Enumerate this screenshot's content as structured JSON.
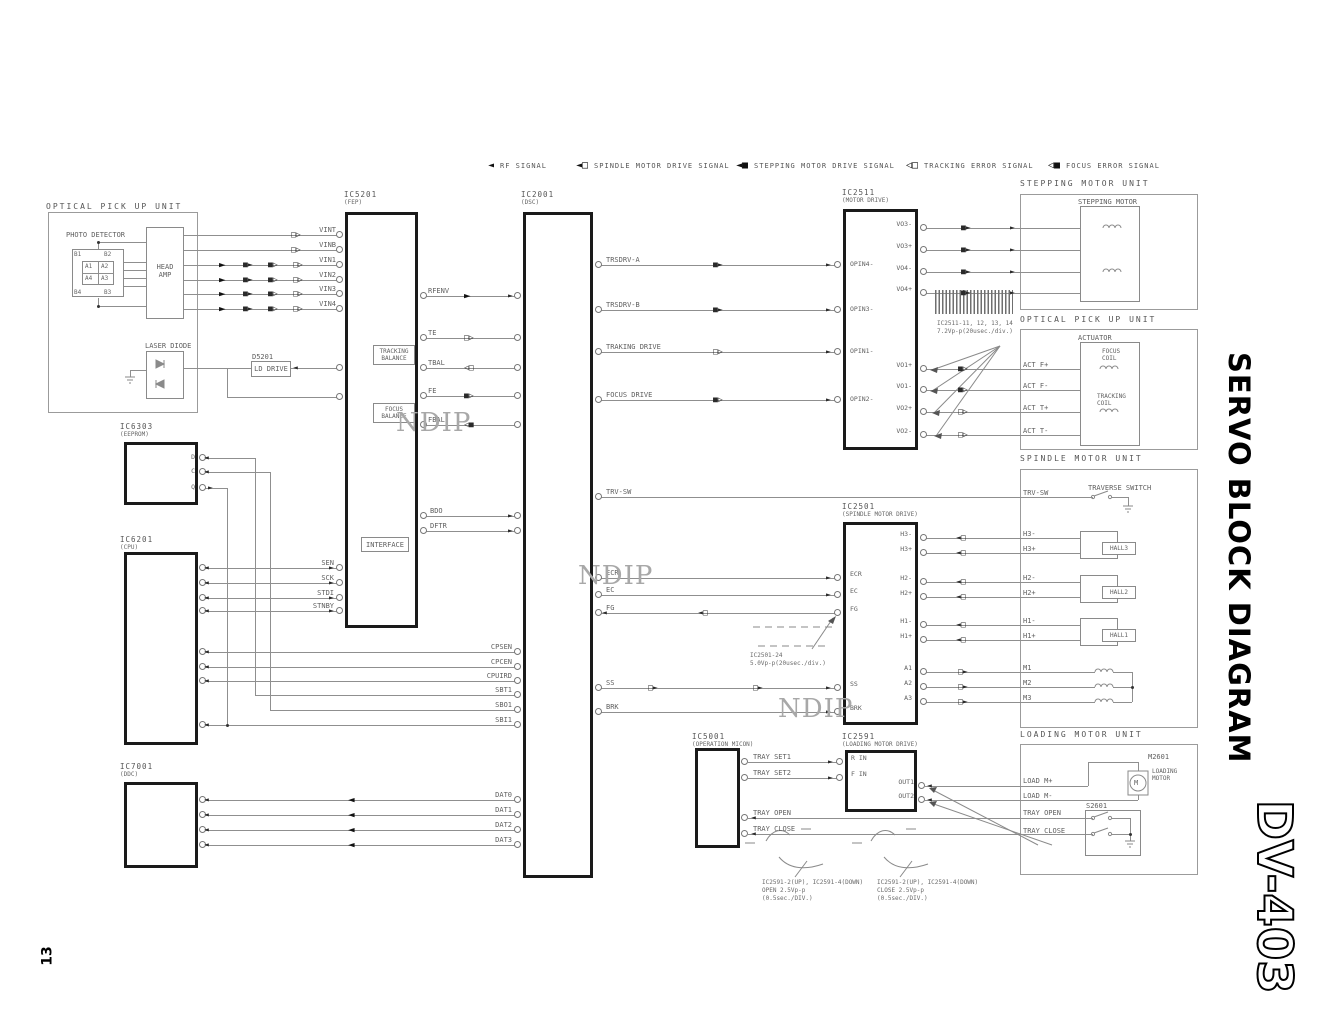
{
  "page": {
    "number": "13",
    "side_title": "SERVO BLOCK DIAGRAM",
    "model": "DV-403",
    "watermark": "NDIP"
  },
  "legend": {
    "rf": "RF SIGNAL",
    "spindle": "SPINDLE MOTOR DRIVE SIGNAL",
    "stepping": "STEPPING MOTOR DRIVE SIGNAL",
    "tracking": "TRACKING ERROR SIGNAL",
    "focus": "FOCUS ERROR SIGNAL"
  },
  "opu_left": {
    "title": "OPTICAL PICK UP UNIT",
    "photo_detector": "PHOTO DETECTOR",
    "cells": [
      "B1",
      "B2",
      "A1",
      "A2",
      "A4",
      "A3",
      "B4",
      "B3"
    ],
    "head_amp": "HEAD\nAMP",
    "laser_diode": "LASER DIODE",
    "d5201": "D5201",
    "ld_drive": "LD DRIVE"
  },
  "ic5201": {
    "name": "IC5201",
    "sub": "(FEP)",
    "inputs": [
      "VINT",
      "VINB",
      "VIN1",
      "VIN2",
      "VIN3",
      "VIN4"
    ],
    "to_dsc": [
      "RFENV",
      "TE",
      "TBAL",
      "FE",
      "FBAL",
      "BDO",
      "DFTR"
    ],
    "serial": [
      "SEN",
      "SCK",
      "STDI",
      "STNBY"
    ],
    "tracking_balance": "TRACKING\nBALANCE",
    "focus_balance": "FOCUS\nBALANCE",
    "interface": "INTERFACE"
  },
  "ic2001": {
    "name": "IC2001",
    "sub": "(DSC)",
    "left": [
      "CPSEN",
      "CPCEN",
      "CPUIRD",
      "SBT1",
      "SBO1",
      "SBI1",
      "DAT0",
      "DAT1",
      "DAT2",
      "DAT3"
    ],
    "right": [
      "TRSDRV-A",
      "TRSDRV-B",
      "TRAKING DRIVE",
      "FOCUS DRIVE",
      "TRV-SW",
      "ECR",
      "EC",
      "FG",
      "SS",
      "BRK"
    ]
  },
  "ic2511": {
    "name": "IC2511",
    "sub": "(MOTOR DRIVE)",
    "left_pins": [
      "OPIN4-",
      "OPIN3-",
      "OPIN1-",
      "OPIN2-"
    ],
    "right_top": [
      "VO3-",
      "VO3+",
      "VO4-",
      "VO4+"
    ],
    "right_bot": [
      "VO1+",
      "VO1-",
      "VO2+",
      "VO2-"
    ]
  },
  "ic2501": {
    "name": "IC2501",
    "sub": "(SPINDLE MOTOR DRIVE)",
    "left_pins": [
      "ECR",
      "EC",
      "FG",
      "SS",
      "BRK"
    ],
    "right_pins": [
      "H3-",
      "H3+",
      "H2-",
      "H2+",
      "H1-",
      "H1+",
      "A1",
      "A2",
      "A3"
    ]
  },
  "ic6303": {
    "name": "IC6303",
    "sub": "(EEPROM)",
    "pins": [
      "D",
      "C",
      "Q"
    ]
  },
  "ic6201": {
    "name": "IC6201",
    "sub": "(CPU)"
  },
  "ic7001": {
    "name": "IC7001",
    "sub": "(DDC)"
  },
  "ic5001": {
    "name": "IC5001",
    "sub": "(OPERATION MICON)",
    "pins": [
      "TRAY SET1",
      "TRAY SET2",
      "TRAY OPEN",
      "TRAY CLOSE"
    ]
  },
  "ic2591": {
    "name": "IC2591",
    "sub": "(LOADING MOTOR DRIVE)",
    "left_pins": [
      "R IN",
      "F IN"
    ],
    "right_pins": [
      "OUT1",
      "OUT2"
    ]
  },
  "stepping_unit": {
    "title": "STEPPING MOTOR UNIT",
    "motor": "STEPPING MOTOR"
  },
  "opu_right": {
    "title": "OPTICAL PICK UP UNIT",
    "actuator": "ACTUATOR",
    "focus_coil": "FOCUS\nCOIL",
    "tracking_coil": "TRACKING\nCOIL",
    "pins": [
      "ACT F+",
      "ACT F-",
      "ACT T+",
      "ACT T-"
    ]
  },
  "spindle_unit": {
    "title": "SPINDLE MOTOR UNIT",
    "traverse_switch": "TRAVERSE SWITCH",
    "trv_sw": "TRV-SW",
    "halls": [
      "HALL3",
      "HALL2",
      "HALL1"
    ],
    "pins": [
      "H3-",
      "H3+",
      "H2-",
      "H2+",
      "H1-",
      "H1+",
      "M1",
      "M2",
      "M3"
    ]
  },
  "loading_unit": {
    "title": "LOADING MOTOR UNIT",
    "m2601": "M2601",
    "loading_motor": "LOADING\nMOTOR",
    "motor_symbol": "M",
    "load_mp": "LOAD M+",
    "load_mm": "LOAD M-",
    "s2601": "S2601",
    "tray_open": "TRAY OPEN",
    "tray_close": "TRAY CLOSE"
  },
  "notes": {
    "stepping_wave": "IC2511-11, 12, 13, 14\n7.2Vp-p(20usec./div.)",
    "spindle_wave": "IC2501-24\n5.0Vp-p(20usec./div.)",
    "load_open": "IC2591-2(UP), IC2591-4(DOWN)\nOPEN 2.5Vp-p\n(0.5sec./DIV.)",
    "load_close": "IC2591-2(UP), IC2591-4(DOWN)\nCLOSE 2.5Vp-p\n(0.5sec./DIV.)"
  }
}
